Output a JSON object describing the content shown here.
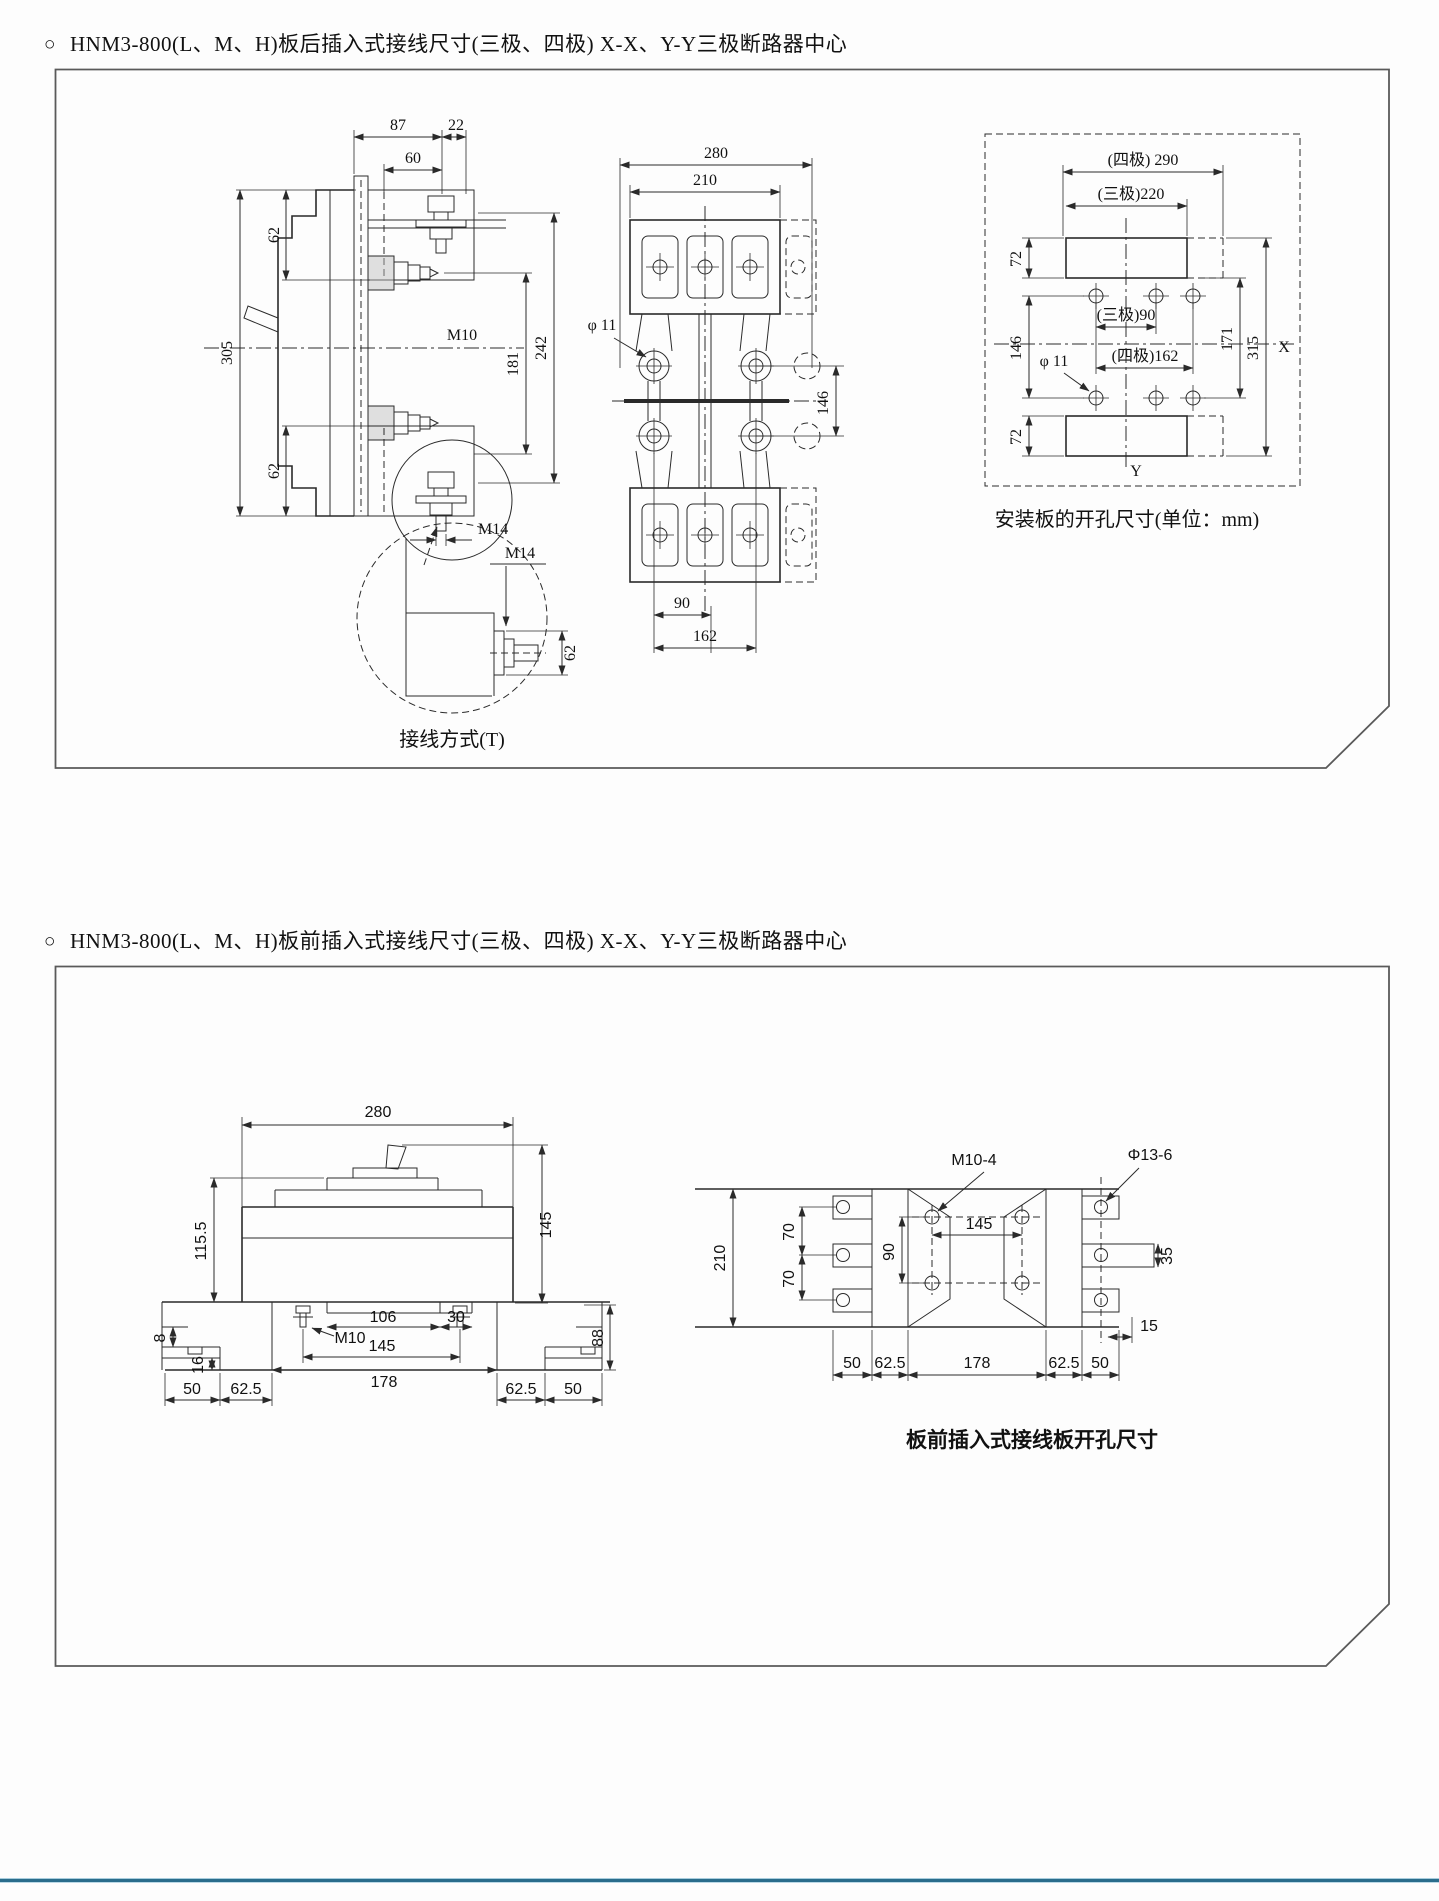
{
  "page": {
    "bullet": "○",
    "title_rear": "HNM3-800(L、M、H)板后插入式接线尺寸(三极、四极) X-X、Y-Y三极断路器中心",
    "title_front": "HNM3-800(L、M、H)板前插入式接线尺寸(三极、四极) X-X、Y-Y三极断路器中心"
  },
  "rear_panel": {
    "side_view": {
      "dim_87": "87",
      "dim_22": "22",
      "dim_60": "60",
      "dim_62_upper": "62",
      "dim_305": "305",
      "dim_62_lower": "62",
      "label_m10": "M10",
      "dim_181": "181",
      "dim_242": "242",
      "label_m14": "M14",
      "detail_m14": "M14",
      "detail_62": "62",
      "caption": "接线方式(T)"
    },
    "front_view": {
      "dim_280": "280",
      "dim_210": "210",
      "label_phi11": "φ 11",
      "dim_146": "146",
      "dim_90": "90",
      "dim_162": "162"
    },
    "drill_plan": {
      "dim_290": "(四极) 290",
      "dim_220": "(三极)220",
      "dim_72_top": "72",
      "dim_146": "146",
      "dim_72_bottom": "72",
      "dim_90": "(三极)90",
      "dim_162": "(四极)162",
      "label_phi11": "φ 11",
      "dim_171": "171",
      "dim_315": "315",
      "axis_x": "X",
      "axis_y": "Y",
      "caption": "安装板的开孔尺寸(单位：mm)"
    }
  },
  "front_panel": {
    "side_view": {
      "dim_280": "280",
      "dim_115_5": "115.5",
      "dim_145_height": "145",
      "dim_106": "106",
      "dim_30": "30",
      "label_m10": "M10",
      "dim_145_span": "145",
      "dim_88": "88",
      "dim_8": "8",
      "dim_16": "16",
      "dim_50_left": "50",
      "dim_62_5_left": "62.5",
      "dim_178": "178",
      "dim_62_5_right": "62.5",
      "dim_50_right": "50"
    },
    "drill_plan": {
      "label_m10_4": "M10-4",
      "label_phi13_6": "Φ13-6",
      "dim_210": "210",
      "dim_70_upper": "70",
      "dim_70_lower": "70",
      "dim_90": "90",
      "dim_145": "145",
      "dim_35": "35",
      "dim_15": "15",
      "dim_50_left": "50",
      "dim_62_5_left": "62.5",
      "dim_178": "178",
      "dim_62_5_right": "62.5",
      "dim_50_right": "50",
      "caption": "板前插入式接线板开孔尺寸"
    }
  }
}
